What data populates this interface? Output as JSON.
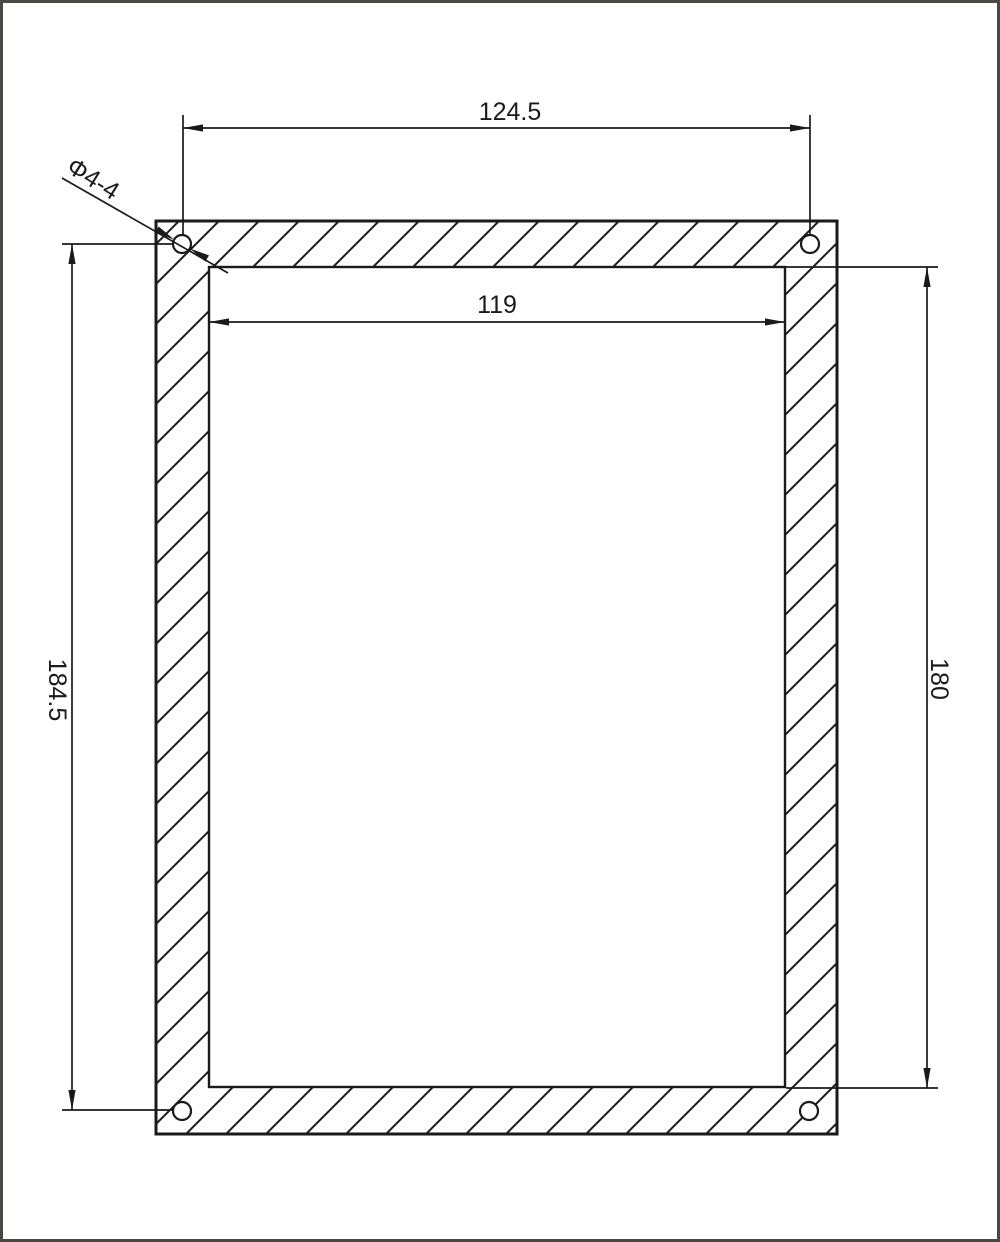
{
  "colors": {
    "line": "#1a1a1a",
    "page_border": "#4a4745",
    "background": "#ffffff"
  },
  "dimensions": {
    "outer_width": "124.5",
    "inner_width": "119",
    "left_height": "184.5",
    "right_height": "180",
    "hole_callout": "Φ4-4"
  }
}
